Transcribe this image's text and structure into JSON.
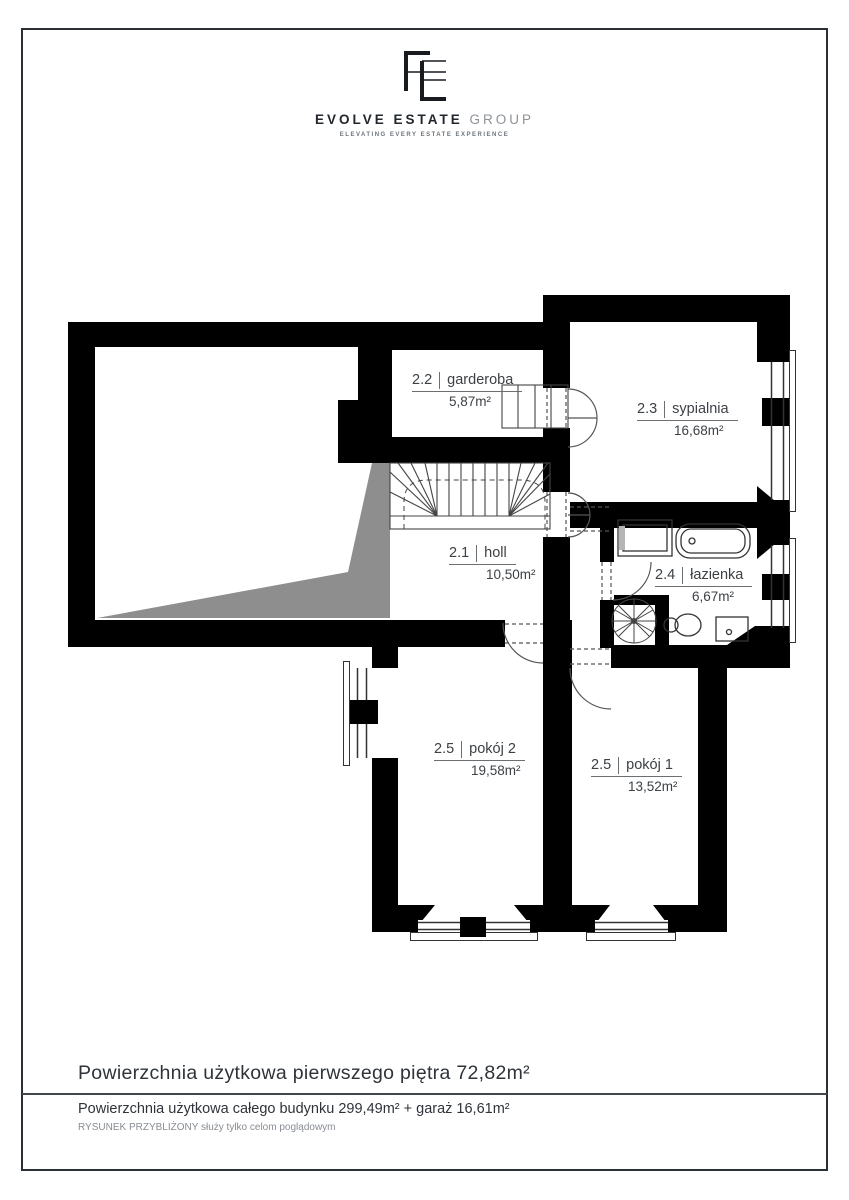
{
  "logo": {
    "monogram": "EE",
    "title_bold": "EVOLVE ESTATE",
    "title_light": "GROUP",
    "tagline": "ELEVATING EVERY ESTATE EXPERIENCE"
  },
  "plan": {
    "rooms": [
      {
        "id": "holl",
        "number": "2.1",
        "name": "holl",
        "area": "10,50m²"
      },
      {
        "id": "garderoba",
        "number": "2.2",
        "name": "garderoba",
        "area": "5,87m²"
      },
      {
        "id": "sypialnia",
        "number": "2.3",
        "name": "sypialnia",
        "area": "16,68m²"
      },
      {
        "id": "lazienka",
        "number": "2.4",
        "name": "łazienka",
        "area": "6,67m²"
      },
      {
        "id": "pokoj2",
        "number": "2.5",
        "name": "pokój 2",
        "area": "19,58m²"
      },
      {
        "id": "pokoj1",
        "number": "2.5",
        "name": "pokój 1",
        "area": "13,52m²"
      }
    ],
    "colors": {
      "wall": "#000000",
      "void_shade": "#8e8e8e",
      "thin_line": "#444444",
      "frame": "#2b3036"
    }
  },
  "footer": {
    "line1": "Powierzchnia użytkowa pierwszego piętra 72,82m²",
    "line2": "Powierzchnia użytkowa całego budynku 299,49m² + garaż 16,61m²",
    "line3": "RYSUNEK PRZYBLIŻONY służy tylko celom poglądowym"
  }
}
